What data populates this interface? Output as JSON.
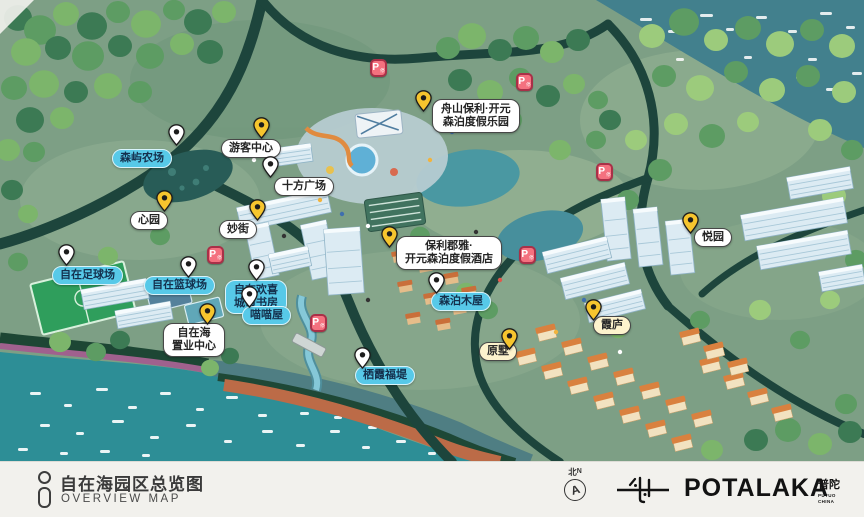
{
  "footer": {
    "title_cn": "自在海园区总览图",
    "title_en": "OVERVIEW MAP",
    "compass_cn": "北",
    "compass_n": "N",
    "compass_glyph": "A",
    "brand": "POTALAKA",
    "brand_seal": "普陀",
    "brand_sub": "PUTUO\nCHINA"
  },
  "map": {
    "parking_label": "P",
    "parking_sub": "停",
    "colors": {
      "pin_yellow": "#f6c52e",
      "pin_white": "#ffffff",
      "label_cyan": "#57c9e8",
      "parking_red": "#f4717f",
      "sea": "#42808d",
      "bay": "#2d8e96",
      "land": "#7d9f85"
    },
    "labels": [
      {
        "id": "senyu-farm",
        "text": "森屿农场",
        "style": "cyan",
        "pin": "white",
        "lx": 112,
        "ly": 149,
        "px": 168,
        "py": 124
      },
      {
        "id": "visitor-center",
        "text": "游客中心",
        "style": "white",
        "pin": "yellow",
        "lx": 221,
        "ly": 139,
        "px": 253,
        "py": 117
      },
      {
        "id": "shifang-plaza",
        "text": "十方广场",
        "style": "white",
        "pin": "white",
        "lx": 274,
        "ly": 177,
        "px": 262,
        "py": 156
      },
      {
        "id": "xin-garden",
        "text": "心园",
        "style": "white",
        "pin": "yellow",
        "lx": 130,
        "ly": 211,
        "px": 156,
        "py": 190
      },
      {
        "id": "miao-street",
        "text": "妙街",
        "style": "white",
        "pin": "yellow",
        "lx": 219,
        "ly": 220,
        "px": 249,
        "py": 199
      },
      {
        "id": "football-field",
        "text": "自在足球场",
        "style": "cyan",
        "pin": "white",
        "lx": 52,
        "ly": 266,
        "px": 58,
        "py": 244
      },
      {
        "id": "basketball-court",
        "text": "自在篮球场",
        "style": "cyan",
        "pin": "white",
        "lx": 144,
        "ly": 276,
        "px": 180,
        "py": 256
      },
      {
        "id": "city-study",
        "text": "自在欢喜\n城市书房",
        "style": "cyan",
        "pin": "white",
        "lx": 225,
        "ly": 280,
        "px": 248,
        "py": 259
      },
      {
        "id": "meow-house",
        "text": "喵喵屋",
        "style": "cyan",
        "pin": "white",
        "lx": 242,
        "ly": 306,
        "px": 241,
        "py": 286
      },
      {
        "id": "sales-center",
        "text": "自在海\n置业中心",
        "style": "white",
        "pin": "yellow",
        "lx": 163,
        "ly": 323,
        "px": 199,
        "py": 303
      },
      {
        "id": "senbo-resort-park",
        "text": "舟山保利·开元\n森泊度假乐园",
        "style": "white",
        "pin": "yellow",
        "lx": 432,
        "ly": 99,
        "px": 415,
        "py": 90
      },
      {
        "id": "senbo-resort-hotel",
        "text": "保利郡雅·\n开元森泊度假酒店",
        "style": "white",
        "pin": "yellow",
        "lx": 396,
        "ly": 236,
        "px": 381,
        "py": 226
      },
      {
        "id": "senbo-cabins",
        "text": "森泊木屋",
        "style": "cyan",
        "pin": "white",
        "lx": 431,
        "ly": 292,
        "px": 428,
        "py": 272
      },
      {
        "id": "yue-garden",
        "text": "悦园",
        "style": "white",
        "pin": "yellow",
        "lx": 694,
        "ly": 228,
        "px": 682,
        "py": 212
      },
      {
        "id": "xia-lodge",
        "text": "霞庐",
        "style": "cream",
        "pin": "yellow",
        "lx": 593,
        "ly": 316,
        "px": 585,
        "py": 299
      },
      {
        "id": "yuan-villa",
        "text": "原墅",
        "style": "cream",
        "pin": "yellow",
        "lx": 479,
        "ly": 342,
        "px": 501,
        "py": 328
      },
      {
        "id": "qixia-dike",
        "text": "栖霞福堤",
        "style": "cyan",
        "pin": "white",
        "lx": 355,
        "ly": 366,
        "px": 354,
        "py": 347
      }
    ],
    "parking_spots": [
      {
        "x": 370,
        "y": 59
      },
      {
        "x": 516,
        "y": 73
      },
      {
        "x": 596,
        "y": 163
      },
      {
        "x": 519,
        "y": 246
      },
      {
        "x": 207,
        "y": 246
      },
      {
        "x": 310,
        "y": 314
      }
    ]
  }
}
